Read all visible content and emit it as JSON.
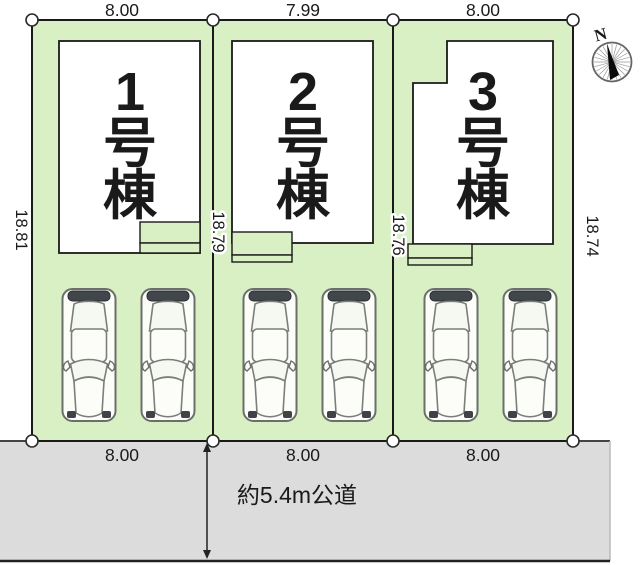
{
  "plots": [
    {
      "building": "1号棟",
      "chars": [
        "1",
        "号",
        "棟"
      ],
      "top_dim": "8.00",
      "bottom_dim": "8.00"
    },
    {
      "building": "2号棟",
      "chars": [
        "2",
        "号",
        "棟"
      ],
      "top_dim": "7.99",
      "bottom_dim": "8.00"
    },
    {
      "building": "3号棟",
      "chars": [
        "3",
        "号",
        "棟"
      ],
      "top_dim": "8.00",
      "bottom_dim": "8.00"
    }
  ],
  "side_dims": {
    "left": "18.81",
    "p1_p2": "18.79",
    "p2_p3": "18.76",
    "right": "18.74"
  },
  "road": {
    "label": "約5.4m公道"
  },
  "compass": {
    "north": "N"
  },
  "colors": {
    "plot_green": "#d9efc4",
    "road_gray": "#dcdcdc",
    "building_white": "#ffffff",
    "line_black": "#1a1a1a"
  }
}
